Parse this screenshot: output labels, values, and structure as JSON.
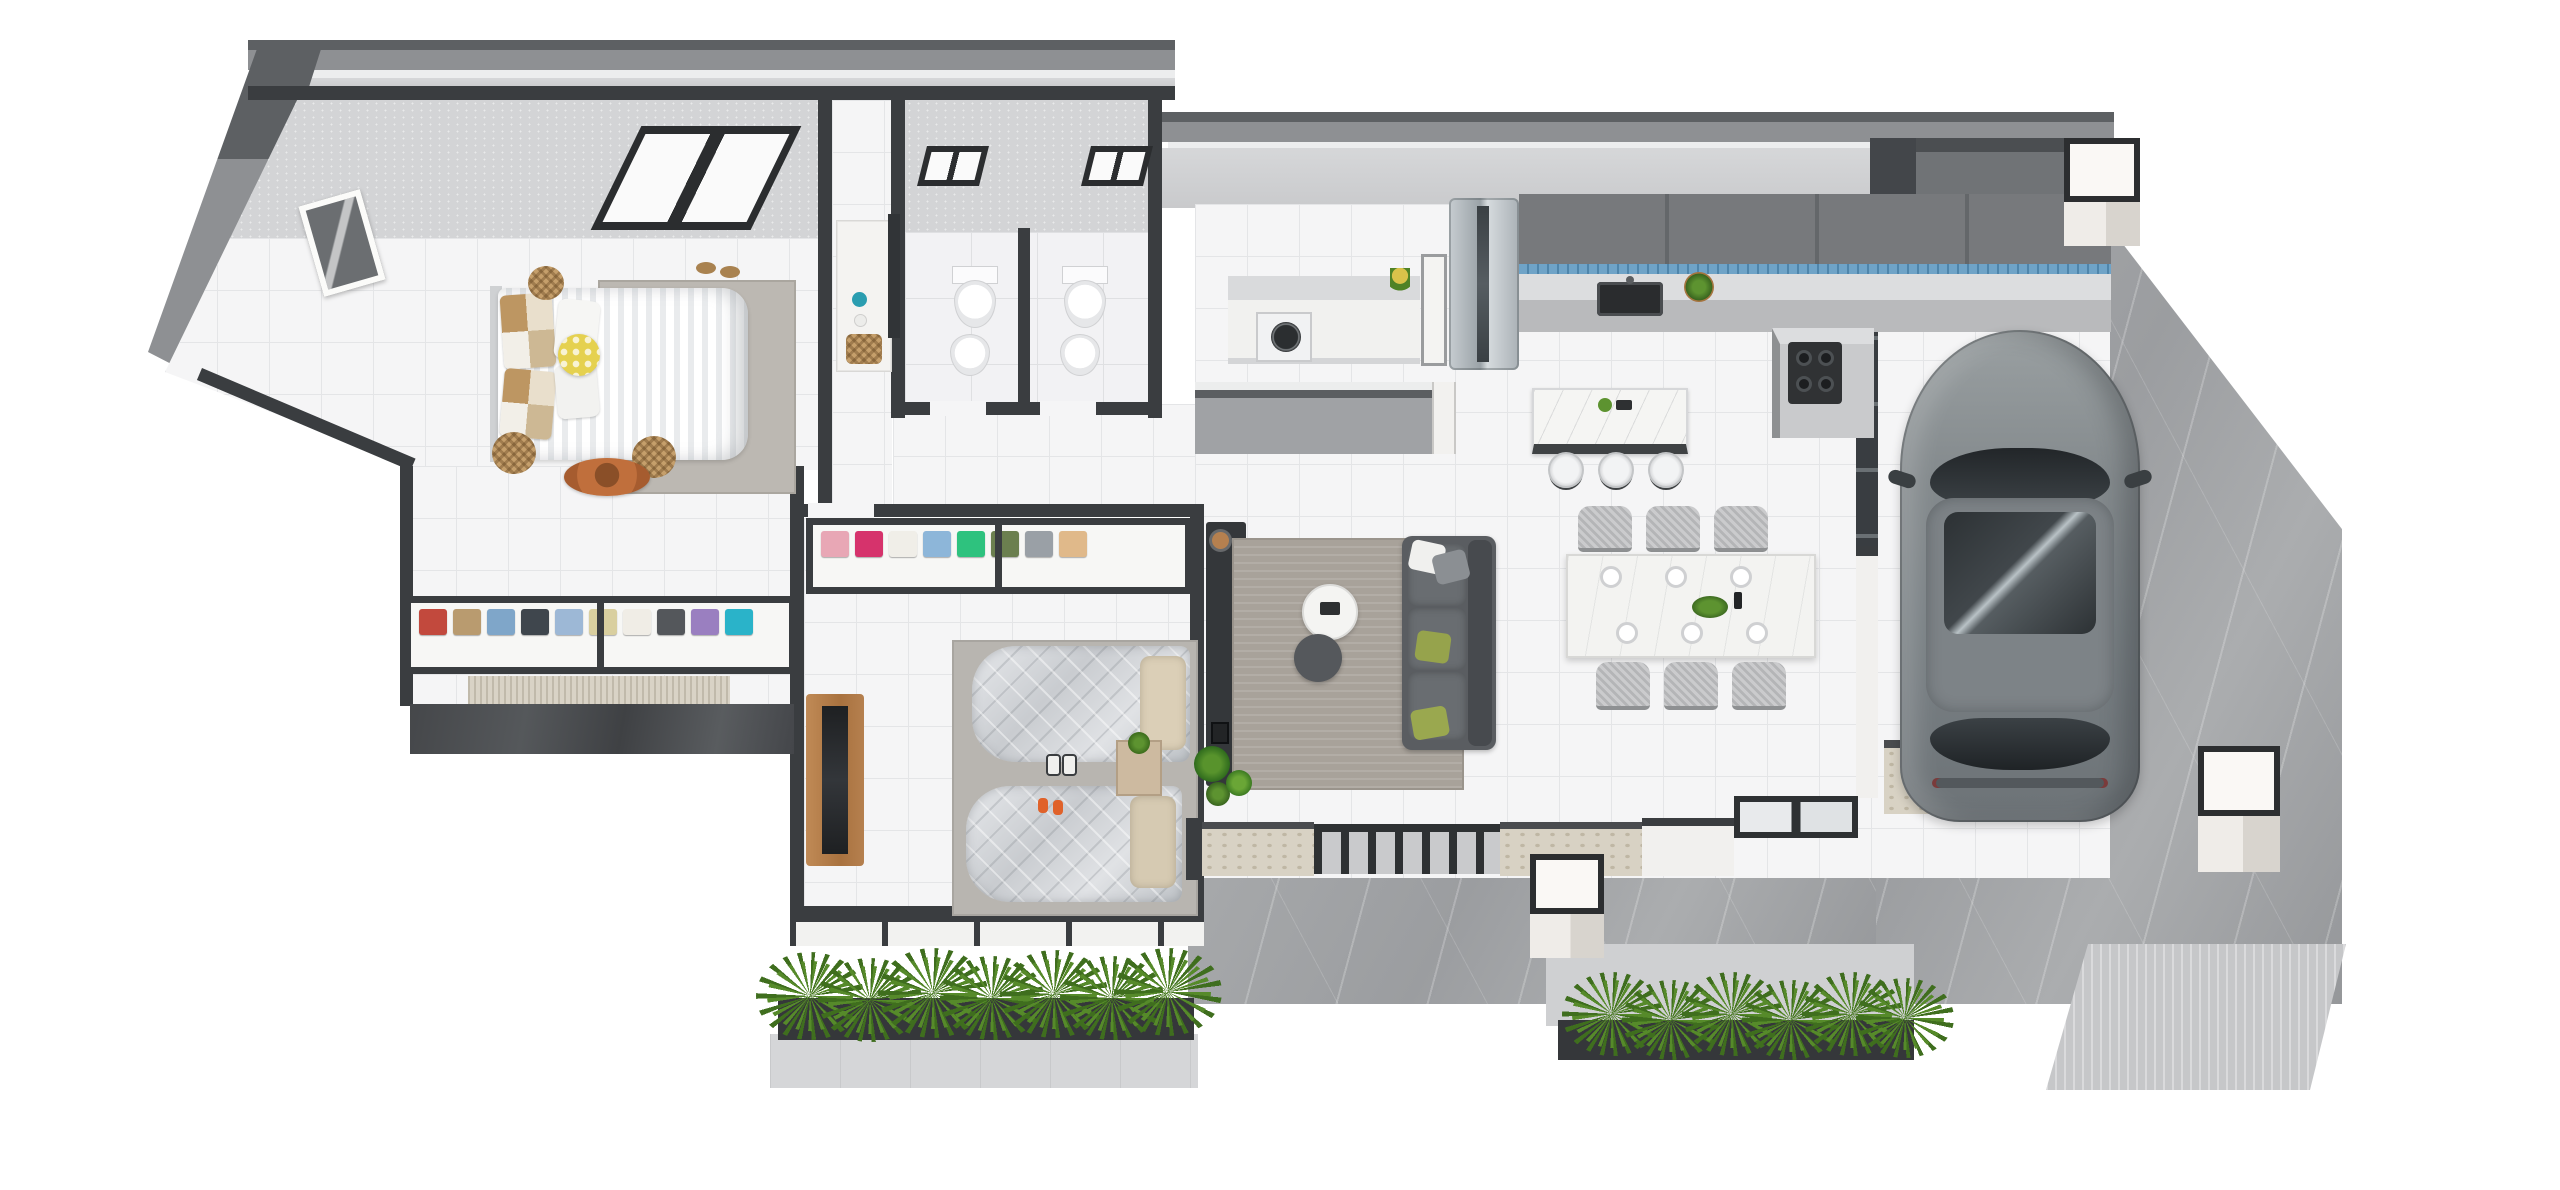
{
  "scene": {
    "label": "3D isometric floor plan rendering of a single-storey house with two bedrooms, two bathrooms, open-plan kitchen, living and dining areas, entry porch and carport with parked SUV",
    "background": "#ffffff"
  },
  "palette": {
    "wall_dark": "#3a3d40",
    "wall_face": "#c7c8ca",
    "wall_inner": "#d3d4d6",
    "roof_dark": "#5d6063",
    "roof_mid": "#8e9093",
    "floor_tile": "#f5f5f6",
    "tile_line": "#e4e5e7",
    "marble_paving": "#a2a4a6",
    "stone_cladding": "#d8d2c4",
    "planter": "#35373a",
    "grass_green": "#3f6e1e",
    "cabinet_gray": "#77797c",
    "backsplash_blue": "#6fa3c7",
    "counter_marble": "#dcdddf",
    "wood": "#b5804f",
    "sofa_gray": "#5a5d61",
    "car_gray": "#7e8487",
    "cushion_yellow": "#e5d14f",
    "silver_bedding": "#d4d6d9"
  },
  "rooms": {
    "master_bedroom": {
      "label": "Master bedroom",
      "items": [
        "double bed with striped duvet",
        "patchwork pillows",
        "yellow polka-dot cushion",
        "area rug",
        "wicker stools",
        "sun hat",
        "wicker basket",
        "wall picture",
        "skylight window",
        "slippers"
      ]
    },
    "walk_in_closet": {
      "label": "Walk-in wardrobe",
      "items": [
        "open shelf with folded clothes",
        "textured runner rug",
        "dark marble step"
      ],
      "clothes_colors": [
        "#c2493d",
        "#b99b6f",
        "#7fa6c9",
        "#3f464d",
        "#9db8d6",
        "#d9cf9f",
        "#f0ede6",
        "#54575b",
        "#9a7fc0",
        "#2ab3c9"
      ]
    },
    "hallway": {
      "label": "Hallway",
      "items": [
        "vanity cabinet",
        "wall mirror",
        "wicker basket",
        "teal decor"
      ]
    },
    "bathroom_left": {
      "label": "Bathroom 1",
      "items": [
        "toilet",
        "bidet",
        "high window"
      ]
    },
    "bathroom_right": {
      "label": "Bathroom 2",
      "items": [
        "toilet",
        "bidet",
        "high window"
      ]
    },
    "laundry": {
      "label": "Laundry nook",
      "items": [
        "washing machine under counter",
        "marble worktop",
        "potted plant",
        "open door"
      ]
    },
    "kids_bedroom": {
      "label": "Second bedroom",
      "items": [
        "two single beds with silver quilts",
        "open wardrobe shelf",
        "nightstand with plant",
        "wooden tv cabinet",
        "sneakers",
        "orange slippers",
        "gray rug"
      ],
      "clothes_colors": [
        "#e8a7b5",
        "#d6336c",
        "#f0eee8",
        "#8db6d9",
        "#2ec27e",
        "#6b7f4f",
        "#9aa0a6",
        "#e0b98a"
      ]
    },
    "living_room": {
      "label": "Living room",
      "items": [
        "charcoal fabric sofa",
        "white and green throw pillows",
        "round coffee tables",
        "woven area rug",
        "media sideboard",
        "table lamp",
        "candle lantern",
        "potted plant"
      ]
    },
    "kitchen": {
      "label": "Kitchen",
      "items": [
        "stainless refrigerator",
        "gray wall cabinets",
        "marble counters",
        "black double sink",
        "gas hob",
        "blue tile backsplash",
        "island breakfast bar",
        "three bar stools",
        "potted herbs"
      ]
    },
    "dining_area": {
      "label": "Dining area",
      "items": [
        "white dining table",
        "six woven chairs",
        "place settings",
        "green centerpiece"
      ]
    },
    "entry_porch": {
      "label": "Entry porch",
      "items": [
        "stone-clad fence walls",
        "dark metal gate",
        "sliding glass doors",
        "cube light pillar",
        "potted plants"
      ]
    },
    "driveway": {
      "label": "Driveway carport",
      "items": [
        "gray SUV with panoramic sunroof",
        "marble paving",
        "cube light pillars",
        "textured street apron"
      ]
    },
    "landscaping": {
      "label": "Landscaping",
      "items": [
        "spiky ornamental grasses in dark planters",
        "pale concrete walkways"
      ]
    }
  }
}
